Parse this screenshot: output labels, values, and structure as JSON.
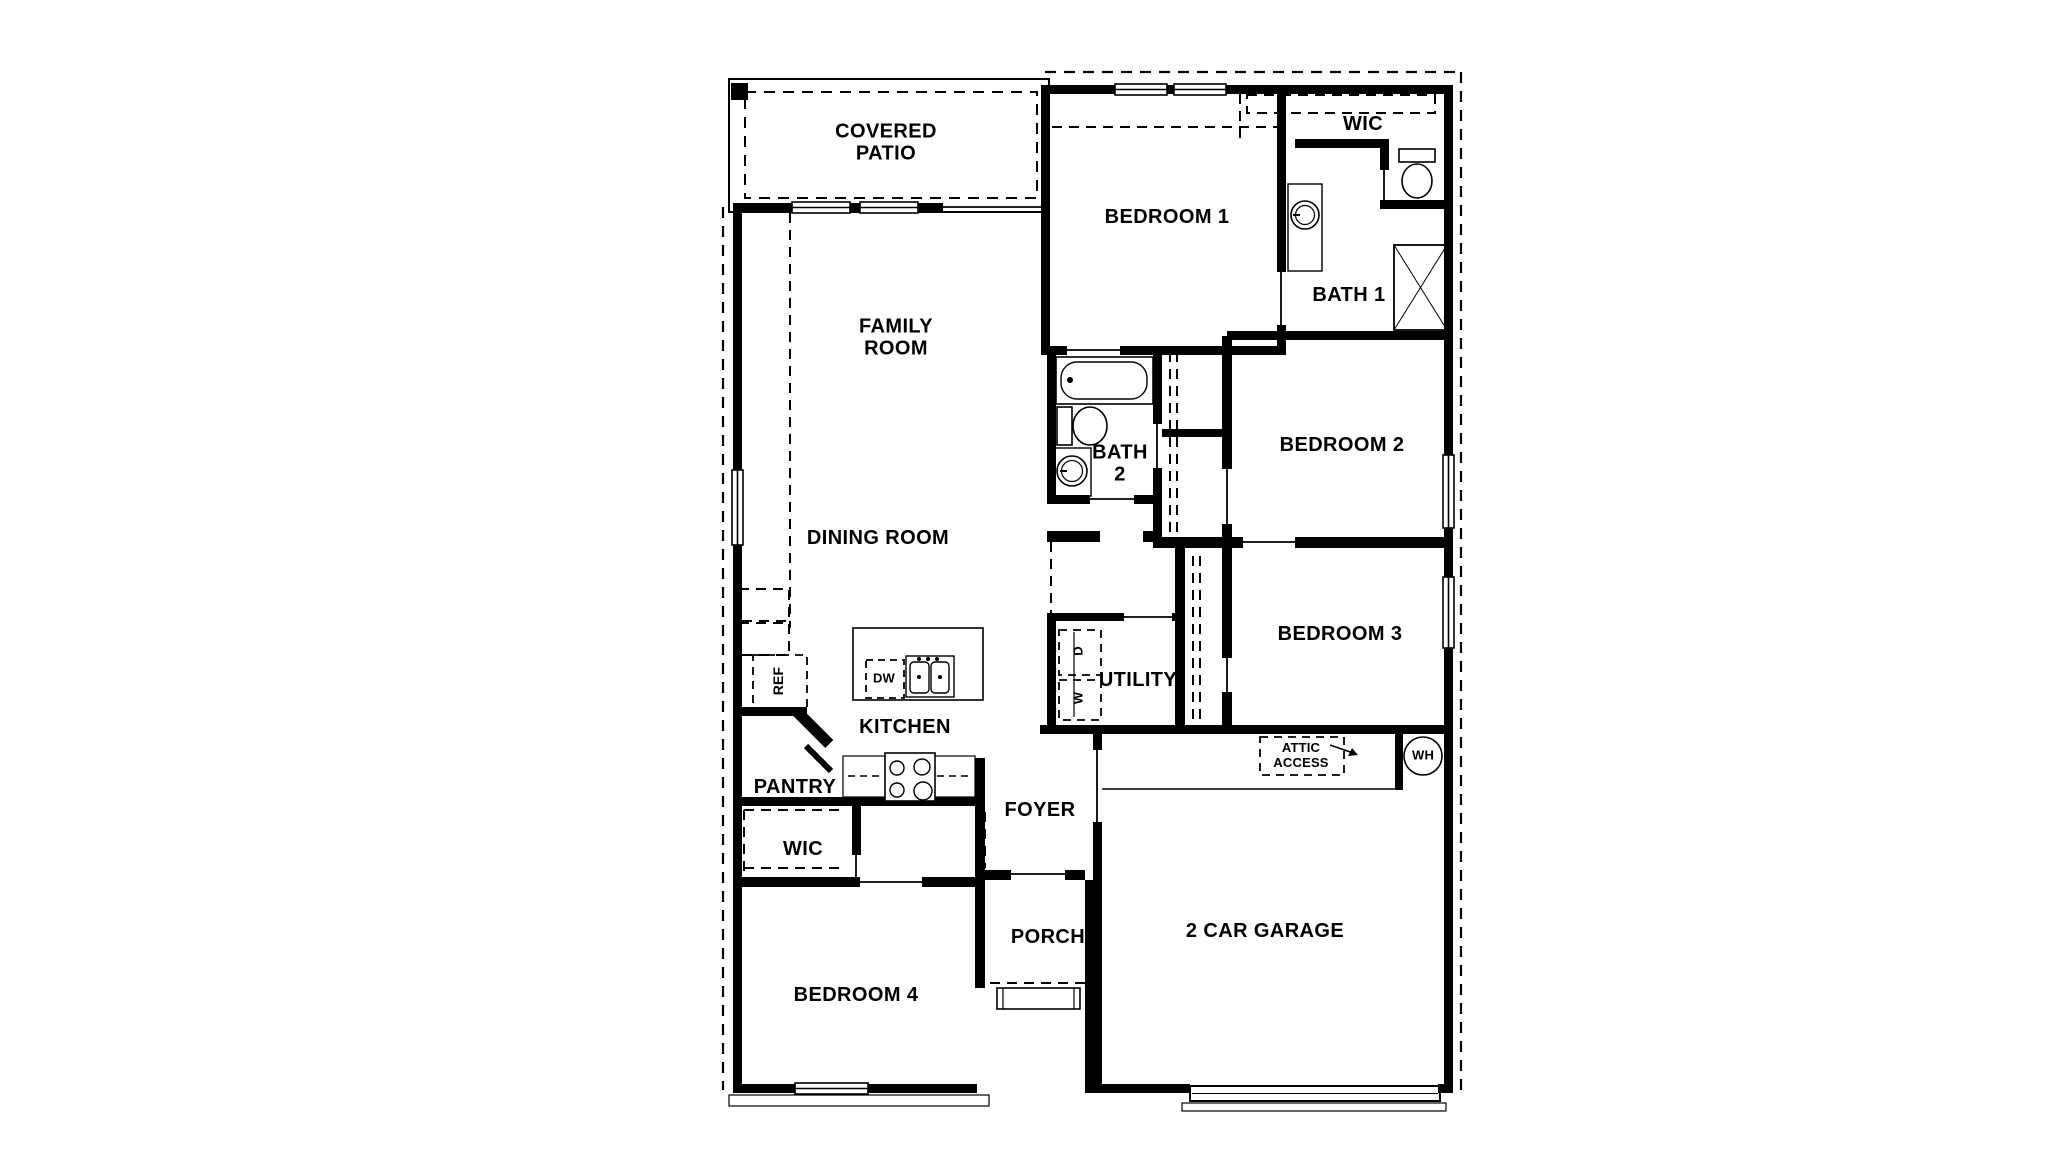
{
  "page": {
    "background": "#ffffff"
  },
  "plan": {
    "wall_color": "#000000",
    "line_color": "#000000",
    "rooms": {
      "covered_patio": {
        "label": "COVERED\nPATIO"
      },
      "bedroom_1": {
        "label": "BEDROOM 1"
      },
      "wic_primary": {
        "label": "WIC"
      },
      "bath_1": {
        "label": "BATH 1"
      },
      "family_room": {
        "label": "FAMILY\nROOM"
      },
      "dining_room": {
        "label": "DINING ROOM"
      },
      "bath_2": {
        "label": "BATH\n2"
      },
      "bedroom_2": {
        "label": "BEDROOM 2"
      },
      "bedroom_3": {
        "label": "BEDROOM 3"
      },
      "utility": {
        "label": "UTILITY"
      },
      "kitchen": {
        "label": "KITCHEN"
      },
      "pantry": {
        "label": "PANTRY"
      },
      "foyer": {
        "label": "FOYER"
      },
      "wic_hall": {
        "label": "WIC"
      },
      "bedroom_4": {
        "label": "BEDROOM 4"
      },
      "porch": {
        "label": "PORCH"
      },
      "garage": {
        "label": "2 CAR GARAGE"
      }
    },
    "fixtures": {
      "refrigerator": "REF",
      "dishwasher": "DW",
      "washer": "W",
      "dryer": "D",
      "water_heater": "WH",
      "attic_access": "ATTIC\nACCESS"
    }
  }
}
